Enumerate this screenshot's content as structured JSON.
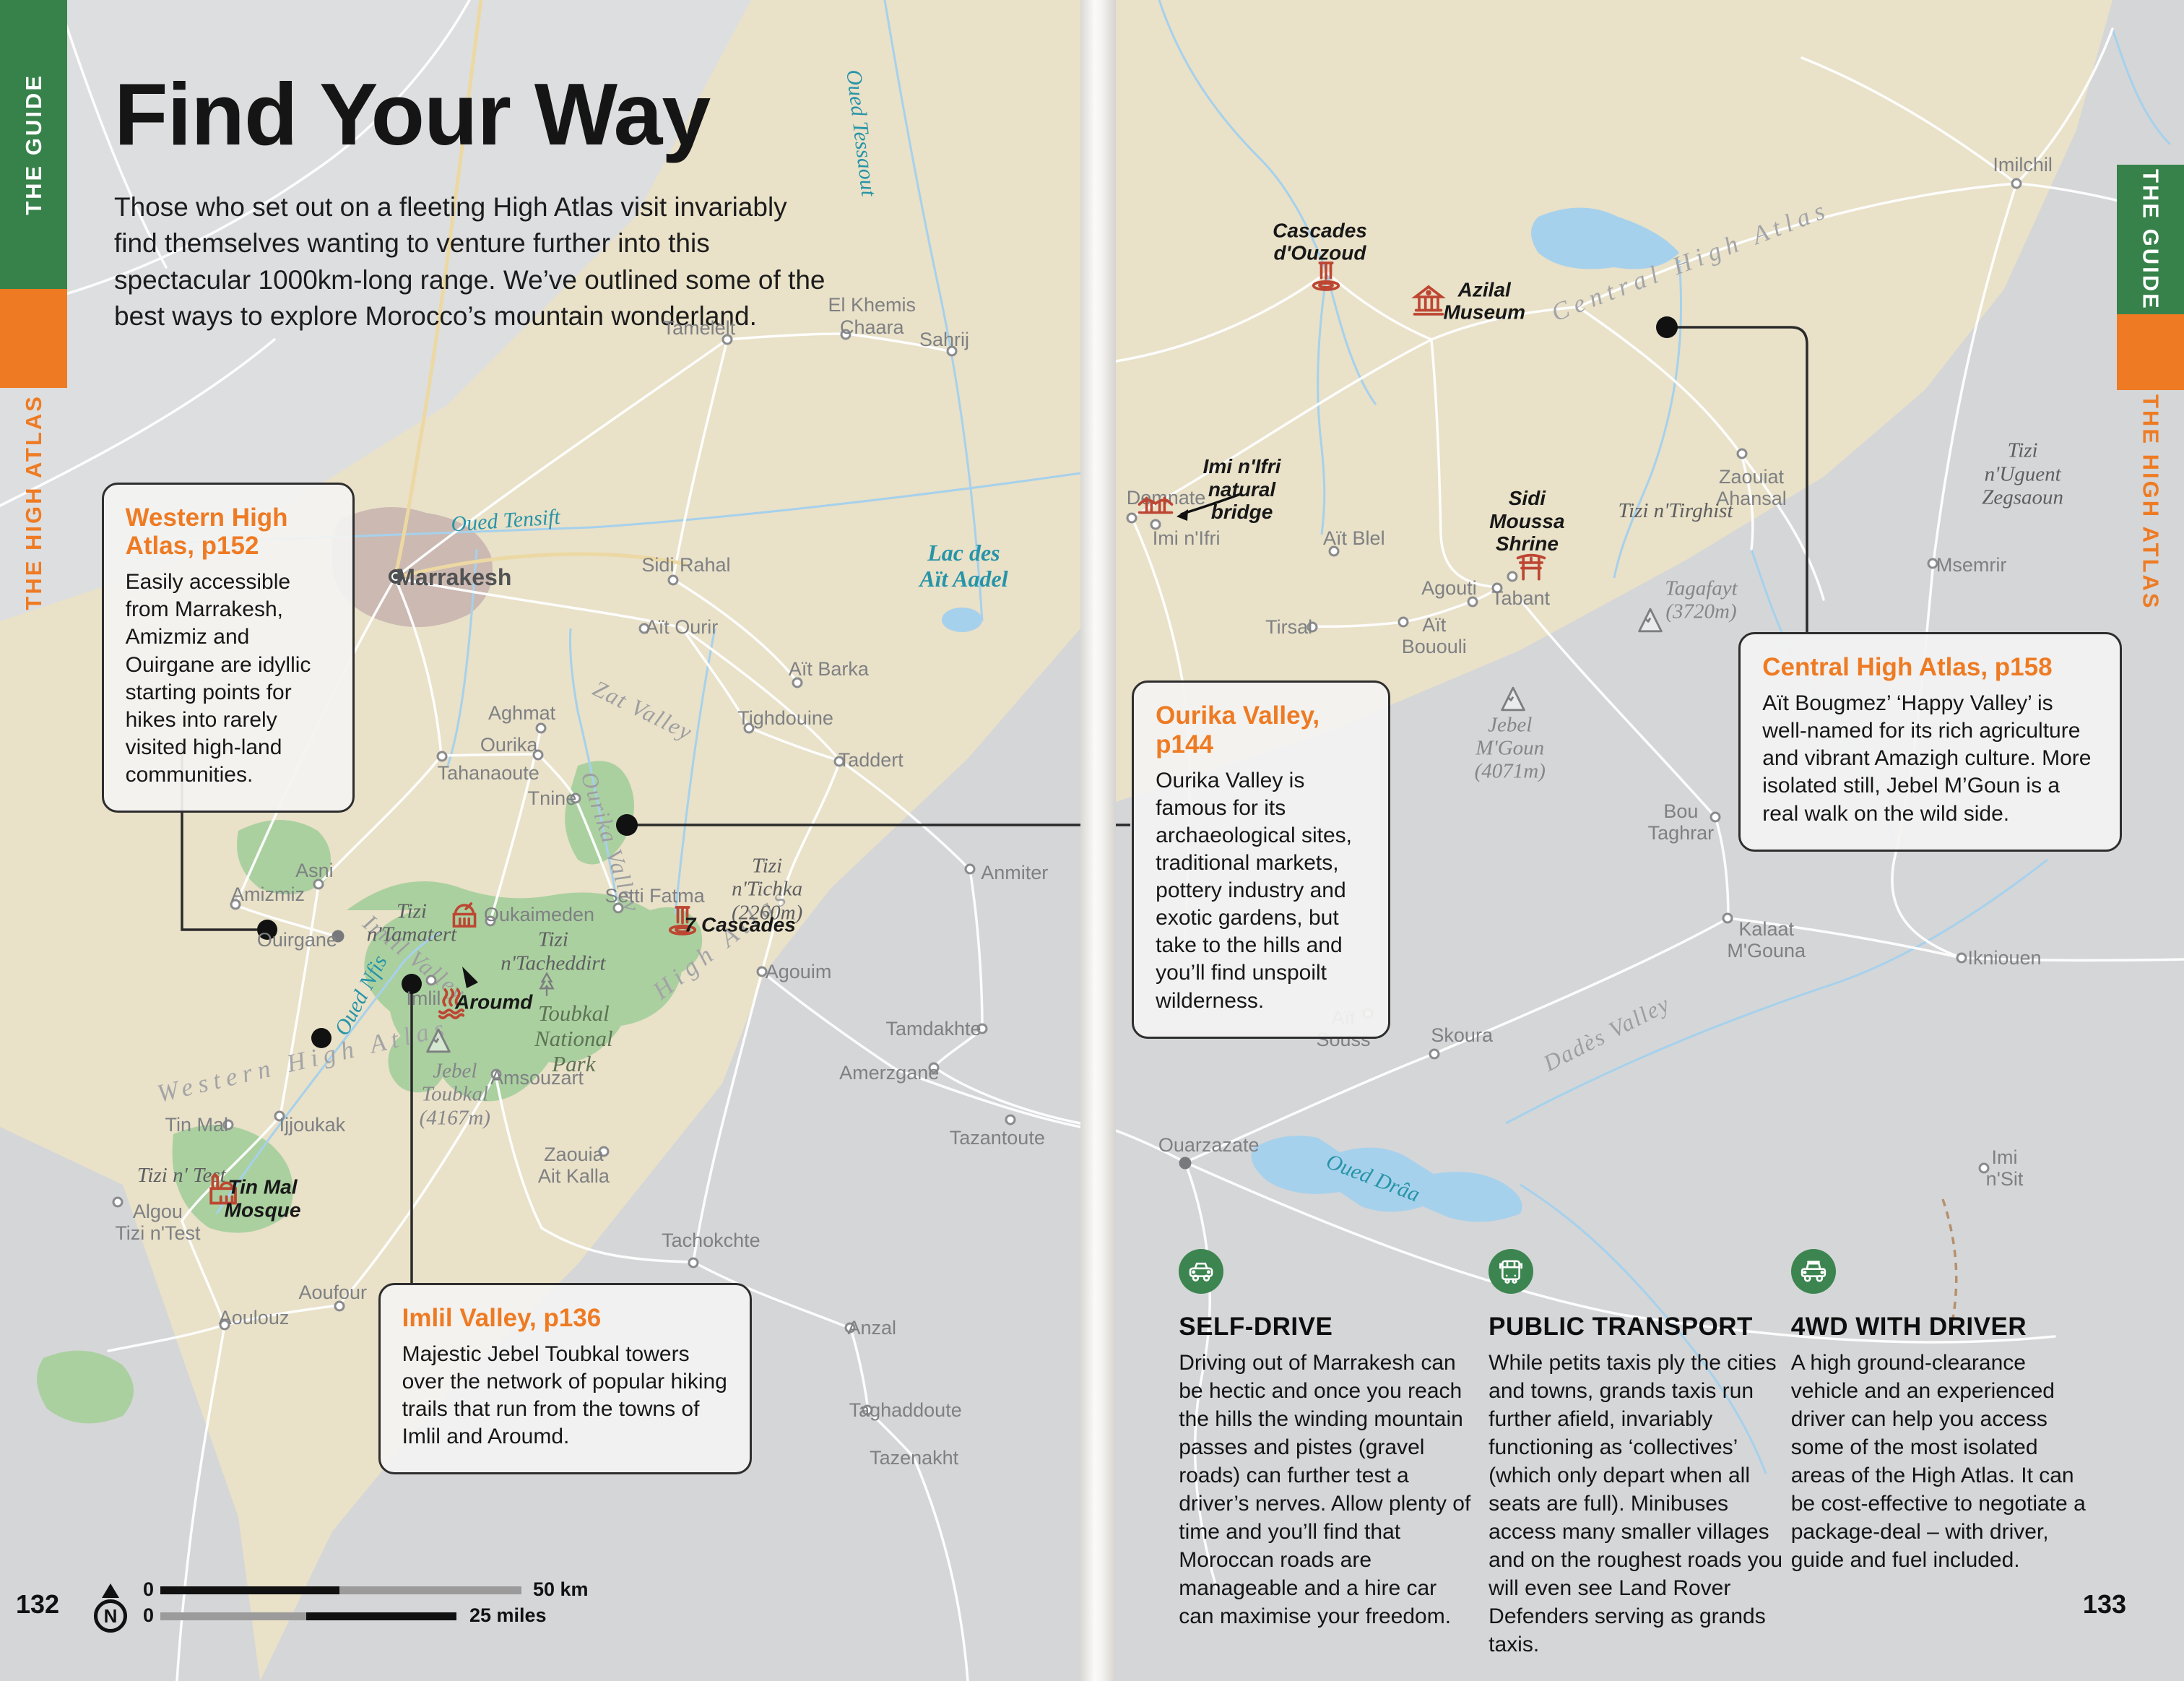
{
  "colors": {
    "orange": "#ee7b23",
    "green": "#37824a",
    "icon_red": "#bd4632",
    "teal": "#2794a8",
    "beige": "#e9e1c8",
    "map_gray": "#d5d6d8",
    "park_green": "#abd0a0",
    "river_blue": "#a6d1ec"
  },
  "left_page": {
    "page_number": "132",
    "edge_tabs": {
      "guide": "THE GUIDE",
      "section": "THE HIGH ATLAS"
    },
    "title": "Find Your Way",
    "intro": "Those who set out on a fleeting High Atlas visit invariably find themselves wanting to venture further into this spectacular 1000km-long range. We’ve outlined some of the best ways to explore Morocco’s mountain wonderland.",
    "callouts": [
      {
        "title": "Western High Atlas, p152",
        "body": "Easily accessible from Marrakesh, Amizmiz and Ouirgane are idyllic starting points for hikes into rarely visited high-land communities."
      },
      {
        "title": "Imlil Valley, p136",
        "body": "Majestic Jebel Toubkal towers over the network of popular hiking trails that run from the towns of Imlil and Aroumd."
      }
    ],
    "scalebar": {
      "zero_km": "0",
      "km_label": "50 km",
      "zero_miles": "0",
      "miles_label": "25 miles",
      "north": "N"
    },
    "labels": [
      {
        "t": "Oued Tessaout",
        "k": "water",
        "x": 79.7,
        "y": 7.9,
        "r": 83
      },
      {
        "t": "Oued Tensift",
        "k": "water",
        "x": 46.8,
        "y": 31.0,
        "r": -4
      },
      {
        "t": "Lac des\nAït Aadel",
        "k": "water",
        "b": true,
        "x": 89.2,
        "y": 33.7
      },
      {
        "t": "Oued Nfis",
        "k": "water",
        "x": 33.4,
        "y": 59.2,
        "r": -62
      },
      {
        "t": "Zat Valley",
        "k": "region",
        "x": 59.5,
        "y": 42.3,
        "r": 26
      },
      {
        "t": "Ourika Valley",
        "k": "region",
        "x": 56.5,
        "y": 50.1,
        "r": 72
      },
      {
        "t": "Imlil Valley",
        "k": "region",
        "x": 38.4,
        "y": 57.0,
        "r": 38
      },
      {
        "t": "Western High Atlas",
        "k": "regionlg",
        "x": 28.1,
        "y": 63.1,
        "r": -13
      },
      {
        "t": "High Atlas",
        "k": "regionlg",
        "x": 66.8,
        "y": 56.1,
        "r": -38
      },
      {
        "t": "Toubkal\nNational\nPark",
        "k": "park",
        "x": 53.1,
        "y": 61.8
      },
      {
        "t": "Tizi\nn'Tichka\n(2260m)",
        "k": "pass",
        "x": 71.0,
        "y": 52.9
      },
      {
        "t": "Tizi\nn'Tamatert",
        "k": "pass",
        "x": 38.1,
        "y": 54.9
      },
      {
        "t": "Tizi\nn'Tacheddirt",
        "k": "pass",
        "x": 51.2,
        "y": 56.6
      },
      {
        "t": "Tizi n' Test",
        "k": "pass",
        "x": 16.8,
        "y": 69.9
      },
      {
        "t": "Jebel\nToubkal\n(4167m)",
        "k": "peak",
        "x": 42.1,
        "y": 65.1,
        "i": "peak",
        "ix": 40.6,
        "iy": 62.0
      },
      {
        "t": "Algou\nTizi n'Test",
        "k": "town",
        "x": 14.6,
        "y": 72.7,
        "m": "ring",
        "mx": 10.9,
        "my": 71.5
      },
      {
        "t": "Marrakesh",
        "k": "city",
        "x": 42.0,
        "y": 34.4,
        "m": "city",
        "mx": 36.6,
        "my": 34.3
      },
      {
        "t": "Tamelelt",
        "k": "town",
        "x": 64.7,
        "y": 19.5,
        "m": "ring",
        "mx": 67.3,
        "my": 20.2
      },
      {
        "t": "El Khemis\nChaara",
        "k": "town",
        "x": 80.7,
        "y": 18.8,
        "m": "ring",
        "mx": 78.3,
        "my": 19.9
      },
      {
        "t": "Sahrij",
        "k": "town",
        "x": 87.4,
        "y": 20.2,
        "m": "ring",
        "mx": 88.1,
        "my": 20.9
      },
      {
        "t": "Sidi Rahal",
        "k": "town",
        "x": 63.5,
        "y": 33.6,
        "m": "ring",
        "mx": 62.3,
        "my": 34.5
      },
      {
        "t": "Aït Ourir",
        "k": "town",
        "x": 63.1,
        "y": 37.3,
        "m": "ring",
        "mx": 59.6,
        "my": 37.4
      },
      {
        "t": "Aït Barka",
        "k": "town",
        "x": 76.7,
        "y": 39.8,
        "m": "ring",
        "mx": 73.8,
        "my": 40.6
      },
      {
        "t": "Tighdouine",
        "k": "town",
        "x": 72.7,
        "y": 42.7,
        "m": "ring",
        "mx": 69.3,
        "my": 43.3
      },
      {
        "t": "Taddert",
        "k": "town",
        "x": 80.6,
        "y": 45.2,
        "m": "ring",
        "mx": 77.7,
        "my": 45.3
      },
      {
        "t": "Aghmat",
        "k": "town",
        "x": 48.3,
        "y": 42.4,
        "m": "ring",
        "mx": 50.1,
        "my": 43.3
      },
      {
        "t": "Ourika",
        "k": "town",
        "x": 47.1,
        "y": 44.3,
        "m": "ring",
        "mx": 49.8,
        "my": 44.9
      },
      {
        "t": "Tahanaoute",
        "k": "town",
        "x": 45.2,
        "y": 46.0,
        "m": "ring",
        "mx": 40.9,
        "my": 45.0
      },
      {
        "t": "Tnine",
        "k": "town",
        "x": 51.1,
        "y": 47.5,
        "m": "ring",
        "mx": 53.3,
        "my": 47.5
      },
      {
        "t": "Asni",
        "k": "town",
        "x": 29.1,
        "y": 51.8,
        "m": "ring",
        "mx": 29.5,
        "my": 52.6
      },
      {
        "t": "Amizmiz",
        "k": "town",
        "x": 24.8,
        "y": 53.2,
        "m": "ring",
        "mx": 21.8,
        "my": 53.8
      },
      {
        "t": "Ouirgane",
        "k": "town",
        "x": 27.5,
        "y": 55.9,
        "m": "dot",
        "mx": 31.3,
        "my": 55.7
      },
      {
        "t": "Setti Fatma",
        "k": "town",
        "x": 60.6,
        "y": 53.3,
        "m": "ring",
        "mx": 57.2,
        "my": 54.0
      },
      {
        "t": "Oukaimeden",
        "k": "town",
        "x": 49.9,
        "y": 54.4,
        "m": "ring",
        "mx": 45.4,
        "my": 54.8,
        "i": "observatory",
        "ix": 43.0,
        "iy": 54.5
      },
      {
        "t": "Imlil",
        "k": "town",
        "x": 39.2,
        "y": 59.4,
        "m": "ring",
        "mx": 39.9,
        "my": 58.3
      },
      {
        "t": "Aroumd",
        "k": "poi",
        "x": 45.7,
        "y": 59.6,
        "i": "hotspring",
        "ix": 41.8,
        "iy": 59.8
      },
      {
        "t": "7 Cascades",
        "k": "poi",
        "x": 68.5,
        "y": 55.0,
        "i": "waterfall",
        "ix": 63.2,
        "iy": 54.9
      },
      {
        "t": "Amsouzart",
        "k": "town",
        "x": 49.7,
        "y": 64.1,
        "m": "ring",
        "mx": 45.9,
        "my": 63.9
      },
      {
        "t": "Zaouia\nAit Kalla",
        "k": "town",
        "x": 53.1,
        "y": 69.3,
        "m": "ring",
        "mx": 55.9,
        "my": 68.5
      },
      {
        "t": "Tin Mal",
        "k": "town",
        "x": 18.2,
        "y": 66.9,
        "m": "ring",
        "mx": 21.1,
        "my": 66.9
      },
      {
        "t": "Tin Mal\nMosque",
        "k": "poi",
        "x": 24.3,
        "y": 71.3,
        "i": "mosque",
        "ix": 20.6,
        "iy": 70.9
      },
      {
        "t": "Ijjoukak",
        "k": "town",
        "x": 28.9,
        "y": 66.9,
        "m": "ring",
        "mx": 25.9,
        "my": 66.4
      },
      {
        "t": "Aoufour",
        "k": "town",
        "x": 30.8,
        "y": 76.9,
        "m": "ring",
        "mx": 31.4,
        "my": 77.7
      },
      {
        "t": "Aoulouz",
        "k": "town",
        "x": 23.5,
        "y": 78.4,
        "m": "ring",
        "mx": 20.8,
        "my": 78.8
      },
      {
        "t": "Anmiter",
        "k": "town",
        "x": 93.9,
        "y": 51.9,
        "m": "ring",
        "mx": 89.8,
        "my": 51.7
      },
      {
        "t": "Agouim",
        "k": "town",
        "x": 73.9,
        "y": 57.8,
        "m": "ring",
        "mx": 70.5,
        "my": 57.8
      },
      {
        "t": "Tamdakhte",
        "k": "town",
        "x": 86.4,
        "y": 61.2,
        "m": "ring",
        "mx": 90.9,
        "my": 61.2
      },
      {
        "t": "Amerzgane",
        "k": "town",
        "x": 82.3,
        "y": 63.8,
        "m": "ring",
        "mx": 86.4,
        "my": 63.5
      },
      {
        "t": "Tazantoute",
        "k": "town",
        "x": 92.3,
        "y": 67.7,
        "m": "ring",
        "mx": 93.5,
        "my": 66.6
      },
      {
        "t": "Tachokchte",
        "k": "town",
        "x": 65.8,
        "y": 73.8,
        "m": "ring",
        "mx": 64.2,
        "my": 75.1
      },
      {
        "t": "Anzal",
        "k": "town",
        "x": 80.7,
        "y": 79.0,
        "m": "ring",
        "mx": 78.7,
        "my": 79.0
      },
      {
        "t": "Taghaddoute",
        "k": "town",
        "x": 83.8,
        "y": 83.9,
        "m": "ring",
        "mx": 80.3,
        "my": 83.9
      },
      {
        "t": "Tazenakht",
        "k": "town",
        "x": 84.6,
        "y": 86.7
      },
      {
        "t": "tree",
        "k": "icononly",
        "x": 50.6,
        "y": 58.7,
        "i": "tree",
        "ix": 50.6,
        "iy": 58.7
      }
    ]
  },
  "right_page": {
    "page_number": "133",
    "edge_tabs": {
      "guide": "THE GUIDE",
      "section": "THE HIGH ATLAS"
    },
    "callouts": [
      {
        "title": "Ourika Valley,\np144",
        "body": "Ourika Valley is famous for its archaeological sites, traditional markets, pottery industry and exotic gardens, but take to the hills and you’ll find unspoilt wilderness."
      },
      {
        "title": "Central High Atlas, p158",
        "body": "Aït Bougmez’ ‘Happy Valley’ is well-named for its rich agriculture and vibrant Amazigh culture. More isolated still, Jebel M’Goun is a real walk on the wild side."
      }
    ],
    "transport": [
      {
        "icon": "car-icon",
        "title": "SELF-DRIVE",
        "body": "Driving out of Marrakesh can be hectic and once you reach the hills the winding mountain passes and pistes (gravel roads) can further test a driver’s nerves. Allow plenty of time and you’ll find that Moroccan roads are manageable and a hire car can maximise your freedom."
      },
      {
        "icon": "bus-icon",
        "title": "PUBLIC TRANSPORT",
        "body": "While petits taxis ply the cities and towns, grands taxis run further afield, invariably functioning as ‘collectives’ (which only depart when all seats are full). Minibuses access many smaller villages and on the roughest roads you will even see Land Rover Defenders serving as grands taxis."
      },
      {
        "icon": "4wd-icon",
        "title": "4WD WITH DRIVER",
        "body": "A high ground-clearance vehicle and an experienced driver can help you access some of the most isolated areas of the High Atlas. It can be cost-effective to negotiate a package-deal – with driver, guide and fuel included."
      }
    ],
    "labels": [
      {
        "t": "Imilchil",
        "k": "town",
        "x": 84.9,
        "y": 9.8,
        "m": "ring",
        "mx": 84.3,
        "my": 10.9
      },
      {
        "t": "Cascades\nd'Ouzoud",
        "k": "poi",
        "x": 19.1,
        "y": 14.4,
        "i": "waterfall",
        "ix": 19.7,
        "iy": 16.6
      },
      {
        "t": "Azilal\nMuseum",
        "k": "poi",
        "x": 34.5,
        "y": 17.9,
        "i": "museum",
        "ix": 29.3,
        "iy": 18.0
      },
      {
        "t": "Central High Atlas",
        "k": "regionlg",
        "x": 53.8,
        "y": 15.5,
        "r": -21
      },
      {
        "t": "Zaouiat\nAhansal",
        "k": "town",
        "x": 59.5,
        "y": 29.0,
        "m": "ring",
        "mx": 58.6,
        "my": 27.0
      },
      {
        "t": "Tizi\nn'Uguent\nZegsaoun",
        "k": "pass",
        "x": 84.9,
        "y": 28.2
      },
      {
        "t": "Msemrir",
        "k": "town",
        "x": 80.1,
        "y": 33.6,
        "m": "ring",
        "mx": 76.5,
        "my": 33.5
      },
      {
        "t": "Tizi n'Tirghist",
        "k": "pass",
        "x": 52.4,
        "y": 30.4
      },
      {
        "t": "Demnate",
        "k": "town",
        "x": 4.7,
        "y": 29.6,
        "m": "ring",
        "mx": 1.5,
        "my": 30.8
      },
      {
        "t": "Imi n'Ifri",
        "k": "town",
        "x": 6.6,
        "y": 32.0,
        "m": "ring",
        "mx": 3.7,
        "my": 31.2
      },
      {
        "t": "Imi n'Ifri\nnatural\nbridge",
        "k": "poi",
        "x": 11.8,
        "y": 29.1,
        "i": "bridge",
        "ix": 3.7,
        "iy": 30.2
      },
      {
        "t": "Aït Blel",
        "k": "town",
        "x": 22.3,
        "y": 32.0,
        "m": "ring",
        "mx": 20.4,
        "my": 32.8
      },
      {
        "t": "Sidi\nMoussa\nShrine",
        "k": "poi",
        "x": 38.5,
        "y": 31.0,
        "i": "shrine",
        "ix": 38.9,
        "iy": 33.9,
        "m": "ring",
        "mx": 37.1,
        "my": 34.3
      },
      {
        "t": "Agouti",
        "k": "town",
        "x": 31.2,
        "y": 35.0,
        "m": "ring",
        "mx": 33.4,
        "my": 35.8
      },
      {
        "t": "Tabant",
        "k": "town",
        "x": 37.9,
        "y": 35.6,
        "m": "ring",
        "mx": 35.7,
        "my": 35.0
      },
      {
        "t": "Tirsal",
        "k": "town",
        "x": 16.2,
        "y": 37.3,
        "m": "ring",
        "mx": 18.4,
        "my": 37.3
      },
      {
        "t": "Aït\nBououli",
        "k": "town",
        "x": 29.8,
        "y": 37.8,
        "m": "ring",
        "mx": 26.9,
        "my": 37.0
      },
      {
        "t": "Tagafayt\n(3720m)",
        "k": "peak",
        "x": 54.8,
        "y": 35.7,
        "i": "peak",
        "ix": 50.0,
        "iy": 37.0
      },
      {
        "t": "Jebel\nM'Goun\n(4071m)",
        "k": "peak",
        "x": 36.9,
        "y": 44.5,
        "i": "peak",
        "ix": 37.2,
        "iy": 41.7
      },
      {
        "t": "Bou\nTaghrar",
        "k": "town",
        "x": 52.9,
        "y": 48.9,
        "m": "ring",
        "mx": 56.1,
        "my": 48.6
      },
      {
        "t": "Kalaat\nM'Gouna",
        "k": "town",
        "x": 60.9,
        "y": 55.9,
        "m": "ring",
        "mx": 57.3,
        "my": 54.6
      },
      {
        "t": "Ikniouen",
        "k": "town",
        "x": 83.2,
        "y": 57.0,
        "m": "ring",
        "mx": 79.2,
        "my": 57.0
      },
      {
        "t": "Aït\nSouss",
        "k": "town",
        "x": 21.3,
        "y": 61.2,
        "m": "ring",
        "mx": 23.6,
        "my": 60.3
      },
      {
        "t": "Skoura",
        "k": "town",
        "x": 32.4,
        "y": 61.6,
        "m": "ring",
        "mx": 29.8,
        "my": 62.7
      },
      {
        "t": "Dadès Valley",
        "k": "region",
        "x": 46.0,
        "y": 61.5,
        "r": -27
      },
      {
        "t": "Ouarzazate",
        "k": "town",
        "x": 8.7,
        "y": 68.1,
        "m": "dot",
        "mx": 6.5,
        "my": 69.2
      },
      {
        "t": "Oued Drâa",
        "k": "water",
        "x": 24.1,
        "y": 70.1,
        "r": 21
      },
      {
        "t": "Imi\nn'Sit",
        "k": "town",
        "x": 83.2,
        "y": 69.5,
        "m": "ring",
        "mx": 81.3,
        "my": 69.5
      }
    ]
  }
}
